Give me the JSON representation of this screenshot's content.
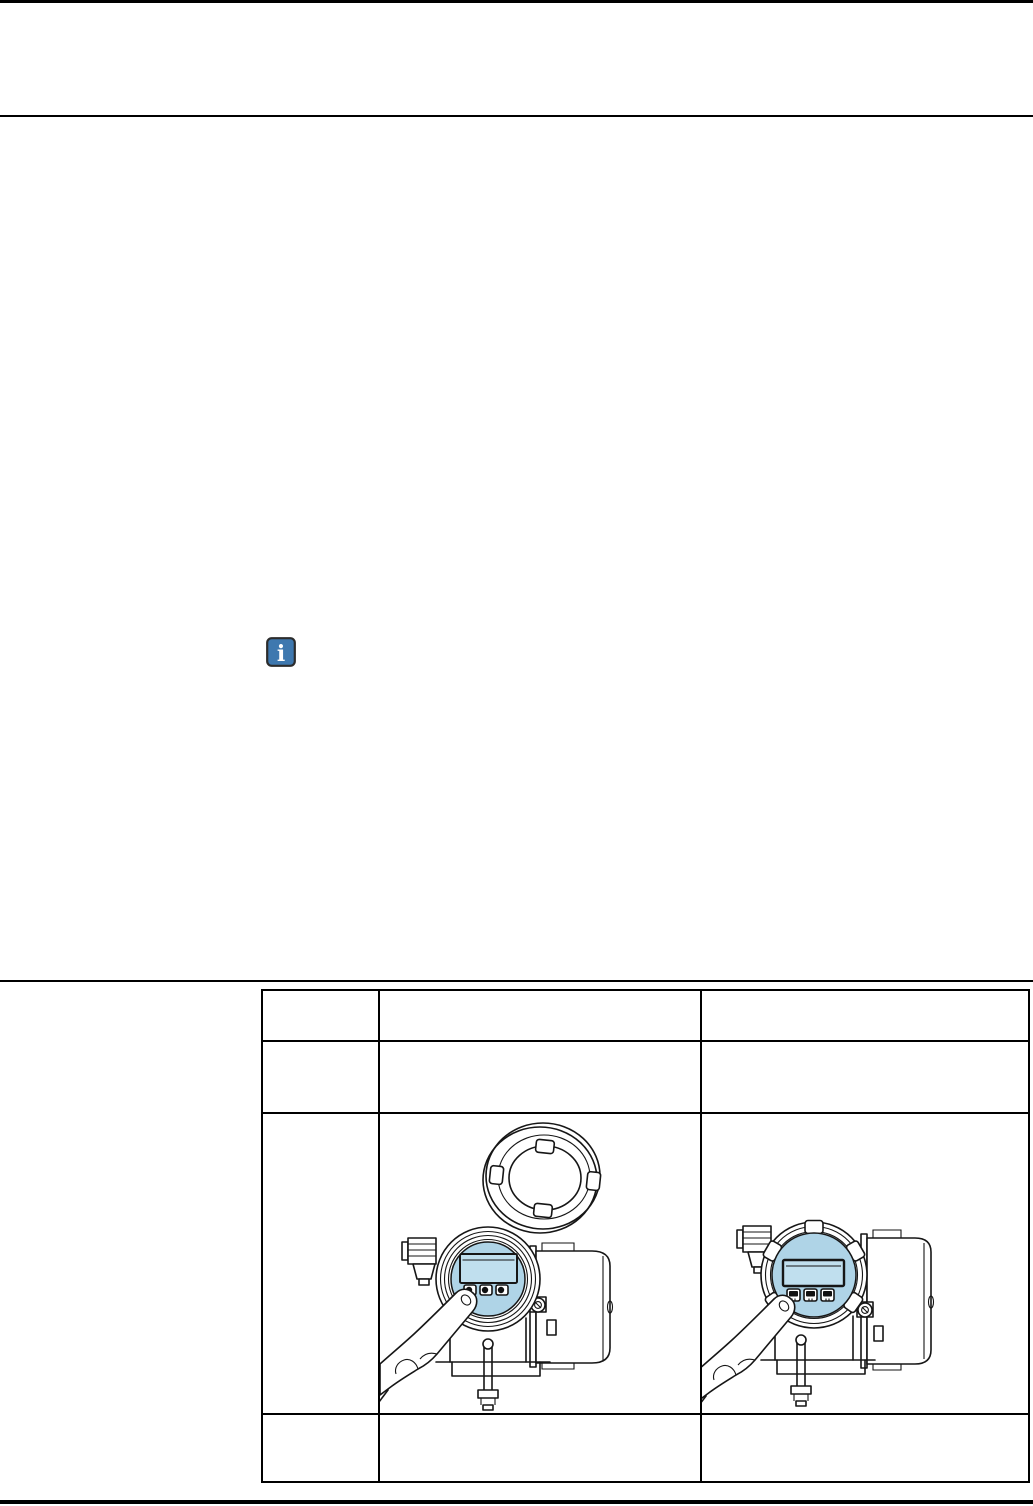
{
  "page": {
    "width": 1033,
    "height": 1506,
    "background": "#ffffff"
  },
  "header": {
    "top_edge_bar_color": "#000000",
    "rule_color": "#000000"
  },
  "info_note": {
    "icon": "info-icon",
    "icon_fill": "#3e78af",
    "icon_border": "#2c2c2c",
    "glyph": "i",
    "glyph_color": "#ffffff"
  },
  "section_rule": {
    "color": "#000000"
  },
  "footer": {
    "rule_color": "#000000"
  },
  "table": {
    "border_color": "#000000",
    "columns": [
      {
        "label": ""
      },
      {
        "label": ""
      },
      {
        "label": ""
      }
    ],
    "rows": [
      {
        "cells": [
          "",
          "",
          ""
        ]
      },
      {
        "cells": [
          "",
          "",
          ""
        ]
      },
      {
        "cells": [
          "",
          "",
          ""
        ]
      },
      {
        "cells": [
          "",
          "",
          ""
        ]
      }
    ]
  },
  "figures": {
    "line_color": "#161616",
    "display_fill": "#afd4e7",
    "lcd_fill": "#c0dfee",
    "open_cover": {
      "icon": "transmitter-display-cover-removed-figure"
    },
    "touch_control": {
      "icon": "transmitter-touch-control-closed-cover-figure"
    }
  }
}
